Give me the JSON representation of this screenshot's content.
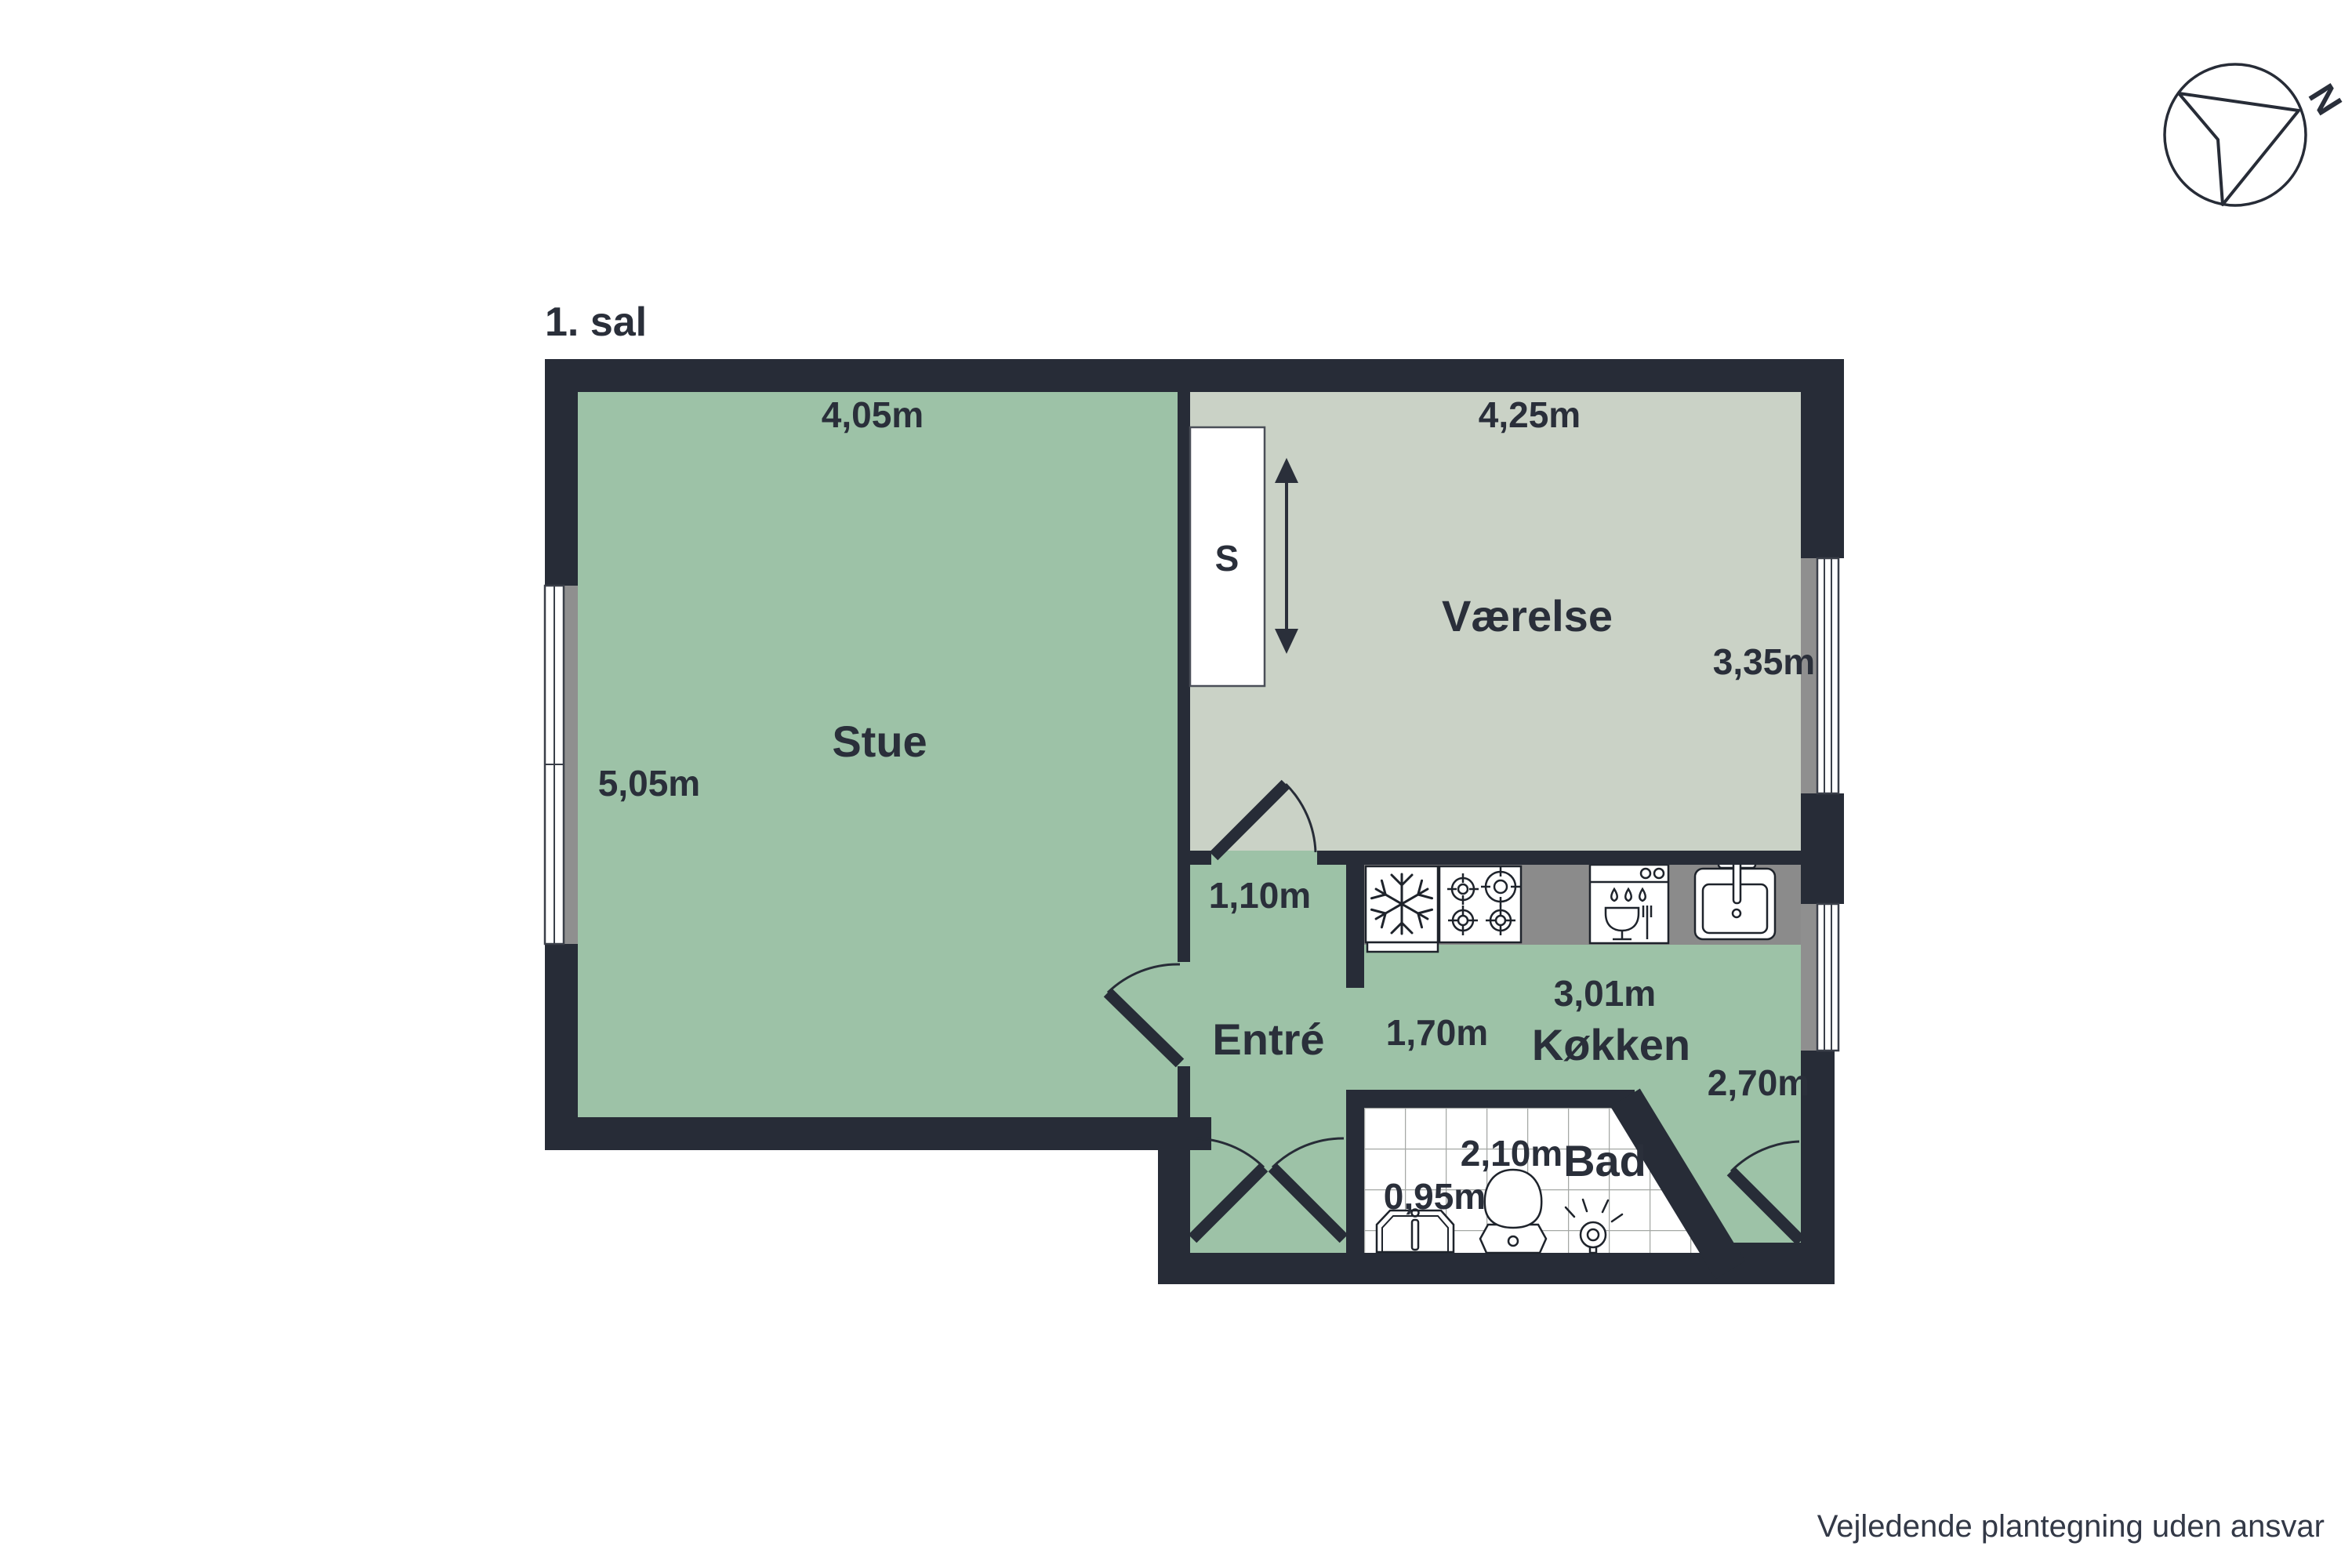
{
  "title": "1. sal",
  "disclaimer": "Vejledende plantegning uden ansvar",
  "compass": {
    "north_label": "N"
  },
  "colors": {
    "wall": "#272C37",
    "stue_entre_koekken_fill": "#9DC2A7",
    "vaerelse_fill": "#CAD2C6",
    "counter_gray": "#8B8B8B",
    "window_sill_gray": "#8F8F8F",
    "tile_line": "#A5A8A5",
    "text": "#2A2F3A"
  },
  "rooms": {
    "stue": {
      "name": "Stue",
      "width": "4,05m",
      "depth": "5,05m"
    },
    "vaerelse": {
      "name": "Værelse",
      "width": "4,25m",
      "depth": "3,35m",
      "closet": "S"
    },
    "entre": {
      "name": "Entré",
      "door_width": "1,10m"
    },
    "koekken": {
      "name": "Køkken",
      "width": "3,01m",
      "clearance": "1,70m",
      "depth": "2,70m"
    },
    "bad": {
      "name": "Bad",
      "width": "2,10m",
      "sink_width": "0,95m"
    }
  },
  "icons": {
    "compass": "compass-north-icon",
    "wardrobe_arrow": "extent-arrow-icon",
    "fridge": "snowflake-fridge-icon",
    "stove": "four-burner-stove-icon",
    "dishwasher": "dishwasher-icon",
    "kitchen_sink": "kitchen-sink-icon",
    "bath_sink": "bathroom-sink-icon",
    "toilet": "toilet-icon",
    "shower": "shower-head-icon"
  }
}
